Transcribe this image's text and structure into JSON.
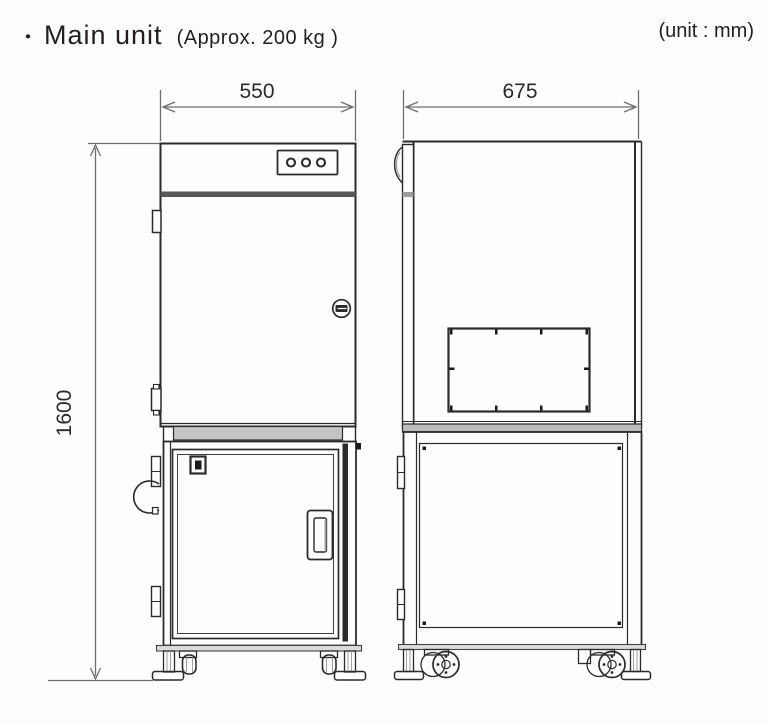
{
  "header": {
    "bullet": "・",
    "title": "Main unit",
    "weight_note": "(Approx. 200 kg )",
    "unit_note": "(unit : mm)"
  },
  "dimensions": {
    "front_width_mm": "550",
    "side_depth_mm": "675",
    "height_mm": "1600"
  },
  "icons": {
    "indicator_lights": "three-round-indicator-lights",
    "door_lock": "quarter-turn-lock",
    "latch": "toggle-latch",
    "handle": "recessed-door-handle",
    "casters": "swivel-casters",
    "leveling_feet": "adjustable-leveling-feet"
  },
  "colors": {
    "line": "#2b2b2d",
    "dimension_line": "#6e6f71",
    "dark_band": "#57585a",
    "ledge_gray": "#c4c4c6",
    "rail_gray": "#dcdcde",
    "background": "#fdfdfd"
  }
}
